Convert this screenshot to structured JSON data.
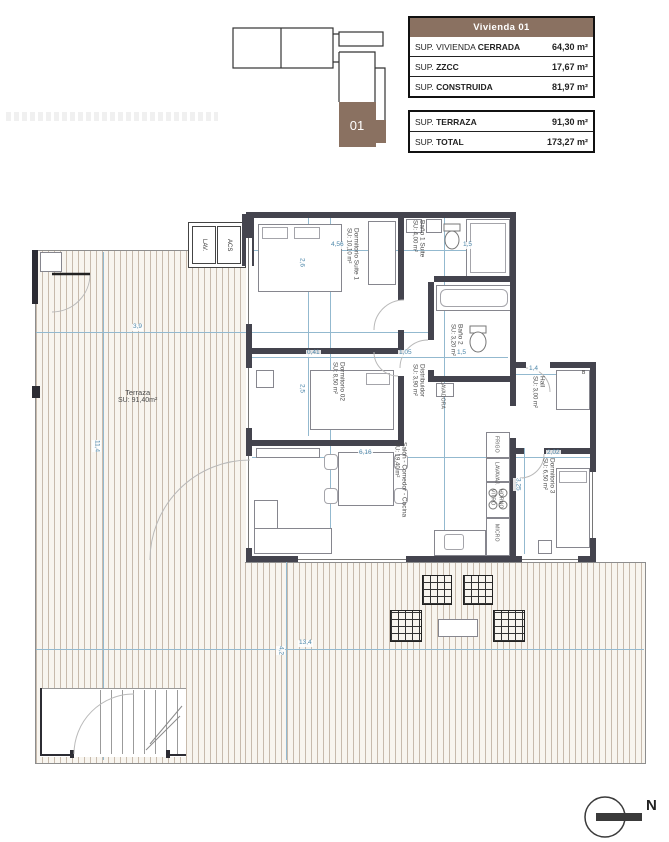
{
  "keyplan": {
    "unit_label": "01"
  },
  "tables": {
    "main": {
      "header": "Vivienda 01",
      "rows": [
        {
          "label_regular": "SUP. VIVIENDA ",
          "label_bold": "CERRADA",
          "value": "64,30 m²"
        },
        {
          "label_regular": "SUP. ",
          "label_bold": "ZZCC",
          "value": "17,67 m²"
        },
        {
          "label_regular": "SUP. ",
          "label_bold": "CONSTRUIDA",
          "value": "81,97 m²"
        }
      ]
    },
    "secondary": {
      "rows": [
        {
          "label_regular": "SUP. ",
          "label_bold": "TERRAZA",
          "value": "91,30 m²"
        },
        {
          "label_regular": "SUP. ",
          "label_bold": "TOTAL",
          "value": "173,27 m²"
        }
      ]
    }
  },
  "plan": {
    "rooms": [
      {
        "id": "dormitorio-suite-1",
        "name": "Dormitorio Suite 1",
        "area": "SU: 10,10 m²",
        "x": 344,
        "y": 228,
        "o": "v"
      },
      {
        "id": "bano-1-suite",
        "name": "Baño 1 Suite",
        "area": "SU: 4,00 m²",
        "x": 410,
        "y": 220,
        "o": "v"
      },
      {
        "id": "bano-2",
        "name": "Baño 2",
        "area": "SU: 3,20 m²",
        "x": 448,
        "y": 324,
        "o": "v"
      },
      {
        "id": "dormitorio-02",
        "name": "Dormitorio 02",
        "area": "SU: 8,50 m²",
        "x": 330,
        "y": 362,
        "o": "v"
      },
      {
        "id": "distribuidor",
        "name": "Distribuidor",
        "area": "SU: 3,90 m²",
        "x": 410,
        "y": 364,
        "o": "v"
      },
      {
        "id": "hall",
        "name": "Hall",
        "area": "SU: 3,00 m²",
        "x": 530,
        "y": 376,
        "o": "v"
      },
      {
        "id": "salon-comedor-cocina",
        "name": "Salón - Comedor - Cocina",
        "area": "SU: 19,40 m²",
        "x": 392,
        "y": 442,
        "o": "v"
      },
      {
        "id": "dormitorio-3",
        "name": "Dormitorio 3",
        "area": "SU: 6,50 m²",
        "x": 540,
        "y": 458,
        "o": "v"
      },
      {
        "id": "terraza",
        "name": "Terraza",
        "area": "SU: 91,40m²",
        "x": 118,
        "y": 388,
        "o": "h"
      }
    ],
    "closets": [
      {
        "label": "LAV."
      },
      {
        "label": "ACS"
      }
    ],
    "hall_closet_label": "B",
    "appliances": [
      {
        "label": "FRIGO",
        "x": 493,
        "y": 436
      },
      {
        "label": "LAVAVAJ.",
        "x": 493,
        "y": 462
      },
      {
        "label": "VITRO",
        "x": 489,
        "y": 489
      },
      {
        "label": "HORNO",
        "x": 497,
        "y": 489
      },
      {
        "label": "MICRO",
        "x": 493,
        "y": 524
      },
      {
        "label": "LAVADORA",
        "x": 439,
        "y": 381
      }
    ],
    "dimensions": [
      {
        "v": "4,56",
        "x": 330,
        "y": 242,
        "o": "h"
      },
      {
        "v": "1,5",
        "x": 462,
        "y": 242,
        "o": "h"
      },
      {
        "v": "2,6",
        "x": 297,
        "y": 258,
        "o": "v"
      },
      {
        "v": "3,9",
        "x": 132,
        "y": 324,
        "o": "h"
      },
      {
        "v": "0,41",
        "x": 306,
        "y": 350,
        "o": "h"
      },
      {
        "v": "1,05",
        "x": 398,
        "y": 350,
        "o": "h"
      },
      {
        "v": "1,5",
        "x": 456,
        "y": 350,
        "o": "h"
      },
      {
        "v": "1,4",
        "x": 528,
        "y": 366,
        "o": "h"
      },
      {
        "v": "2,5",
        "x": 297,
        "y": 384,
        "o": "v"
      },
      {
        "v": "6,16",
        "x": 358,
        "y": 450,
        "o": "h"
      },
      {
        "v": "2,02",
        "x": 546,
        "y": 450,
        "o": "h"
      },
      {
        "v": "3,25",
        "x": 513,
        "y": 478,
        "o": "v"
      },
      {
        "v": "13,4",
        "x": 298,
        "y": 640,
        "o": "h"
      },
      {
        "v": "4,2",
        "x": 276,
        "y": 646,
        "o": "v"
      },
      {
        "v": "11,4",
        "x": 92,
        "y": 440,
        "o": "v"
      }
    ],
    "north_label": "N"
  }
}
